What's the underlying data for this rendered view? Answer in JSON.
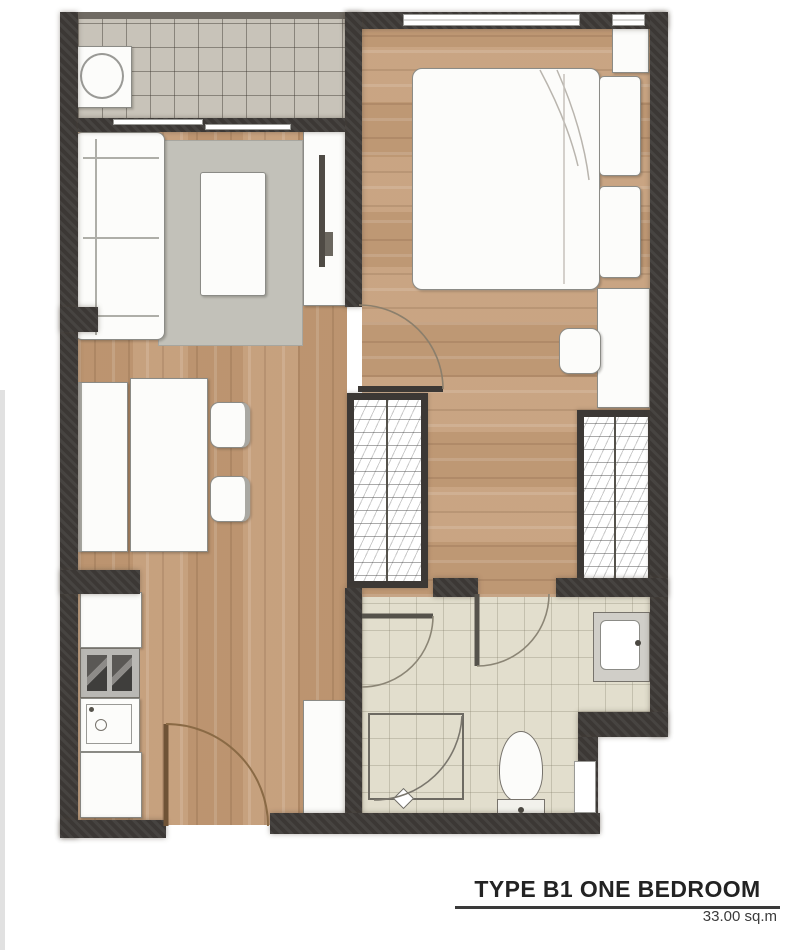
{
  "caption": {
    "title": "TYPE B1 ONE BEDROOM",
    "area": "33.00 sq.m"
  },
  "plan": {
    "unit_type": "B1",
    "layout": "ONE BEDROOM",
    "area_sqm": "33.00",
    "colors": {
      "wall": "#3c3835",
      "wood_floor": "#c39b76",
      "balcony_tile": "#c8c3b9",
      "bathroom_tile": "#e2decd",
      "rug": "#c2c1b9",
      "furniture": "#fcfcfa",
      "entry_door_swing": "#8a6a45",
      "caption_text": "#232323"
    },
    "rooms": [
      "balcony",
      "living-room",
      "dining-area",
      "kitchen",
      "entry-hall",
      "bedroom",
      "wardrobe-corridor",
      "bathroom"
    ],
    "fixtures": [
      "washing-machine",
      "sofa",
      "rug",
      "coffee-table",
      "tv-console",
      "tv",
      "dining-bench",
      "dining-table",
      "dining-chair",
      "dining-chair",
      "kitchen-counter",
      "stove",
      "kitchen-sink",
      "tall-cabinet",
      "double-bed",
      "pillow",
      "pillow",
      "nightstand",
      "dressing-table",
      "stool",
      "wardrobe-left",
      "wardrobe-right",
      "shower-enclosure",
      "shower-head",
      "toilet",
      "vanity-basin",
      "wall-niche",
      "entry-door",
      "bedroom-door",
      "bathroom-door",
      "bathroom-door-2",
      "sliding-balcony-door",
      "window",
      "window"
    ]
  }
}
